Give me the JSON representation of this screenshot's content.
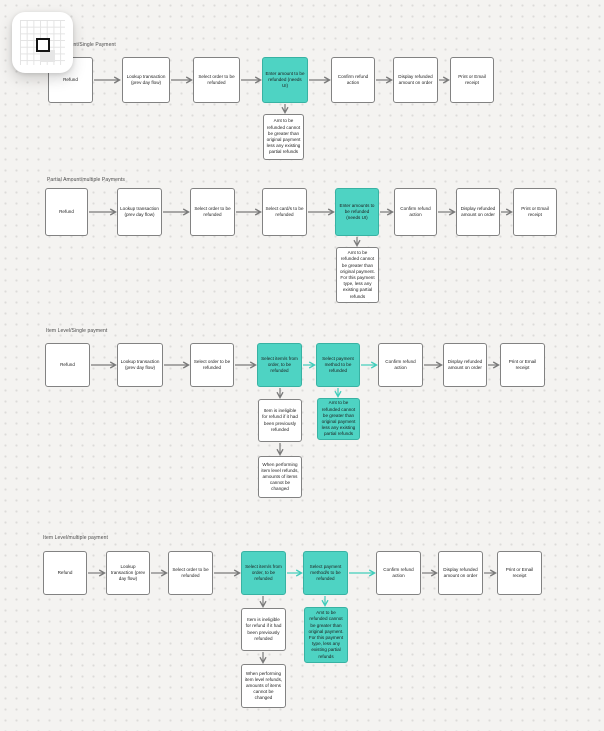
{
  "colors": {
    "canvas_bg": "#f4f3f1",
    "dot_grid": "#dcdbd9",
    "node_fill": "#ffffff",
    "node_border": "#828282",
    "teal_fill": "#4ed3c3",
    "teal_border": "#38b2a3",
    "arrow_gray": "#7a7a7a",
    "arrow_teal": "#41cdbb"
  },
  "widget": {
    "name": "grid overview navigator",
    "viewport_marker": "small square"
  },
  "flows": [
    {
      "title": "Partial Amount/Single Payment",
      "steps": [
        "Refund",
        "Lookup transaction (prev day flow)",
        "Select order to be refunded",
        "Enter amount to be refunded (needs UI)",
        "Confirm refund action",
        "Display refunded amount on order",
        "Print or Email receipt"
      ],
      "notes": [
        "Amt to be refunded cannot be greater than original payment less any existing partial refunds"
      ]
    },
    {
      "title": "Partial Amount/multiple Payments",
      "steps": [
        "Refund",
        "Lookup transaction (prev day flow)",
        "Select order to be refunded",
        "Select card/s to be refunded",
        "Enter amounts to be refunded (needs UI)",
        "Confirm refund action",
        "Display refunded amount on order",
        "Print or Email receipt"
      ],
      "notes": [
        "Amt to be refunded cannot be greater than original payment. For this payment type, less any existing partial refunds"
      ]
    },
    {
      "title": "Item Level/Single payment",
      "steps": [
        "Refund",
        "Lookup transaction (prev day flow)",
        "Select order to be refunded",
        "Select item/s from order, to be refunded",
        "Select payment method to be refunded",
        "Confirm refund action",
        "Display refunded amount on order",
        "Print or Email receipt"
      ],
      "notes": [
        "Item is ineligible for refund if it had been previously refunded",
        "When performing item level refunds, amounts of items cannot be changed",
        "Amt to be refunded cannot be greater than original payment less any existing partial refunds"
      ]
    },
    {
      "title": "Item Level/multiple payment",
      "steps": [
        "Refund",
        "Lookup transaction (prev day flow)",
        "Select order to be refunded",
        "Select item/s from order, to be refunded",
        "Select payment method/s to be refunded",
        "Confirm refund action",
        "Display refunded amount on order",
        "Print or Email receipt"
      ],
      "notes": [
        "Item is ineligible for refund if it had been previously refunded",
        "When performing item level refunds, amounts of items cannot be changed",
        "Amt to be refunded cannot be greater than original payment. For this payment type, less any existing partial refunds"
      ]
    }
  ]
}
